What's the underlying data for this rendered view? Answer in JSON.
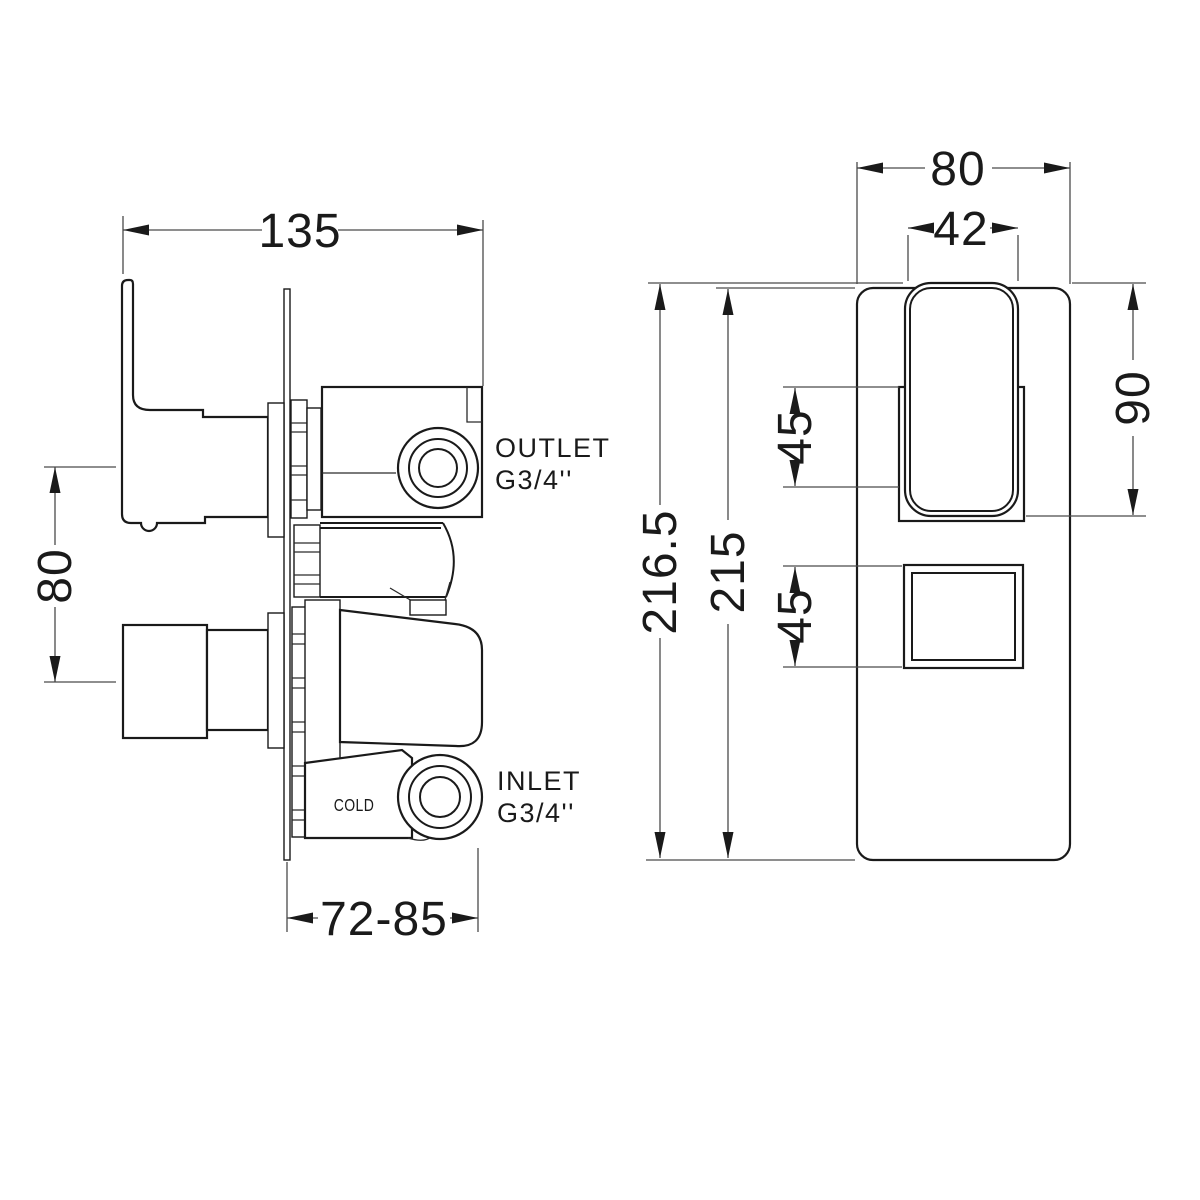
{
  "side_view": {
    "labels": {
      "outlet_line1": "OUTLET",
      "outlet_line2": "G3/4''",
      "inlet_line1": "INLET",
      "inlet_line2": "G3/4''",
      "cold": "COLD"
    },
    "dimensions": {
      "overall_width": "135",
      "control_spacing": "80",
      "install_depth": "72-85"
    }
  },
  "front_view": {
    "dimensions": {
      "plate_width": "80",
      "lever_width": "42",
      "overall_height": "216.5",
      "plate_height": "215",
      "lever_zone": "45",
      "knob_zone": "45",
      "lever_height": "90"
    }
  },
  "colors": {
    "line": "#1a1a1a",
    "dimension_line": "#4a4a4a",
    "background": "#ffffff"
  }
}
